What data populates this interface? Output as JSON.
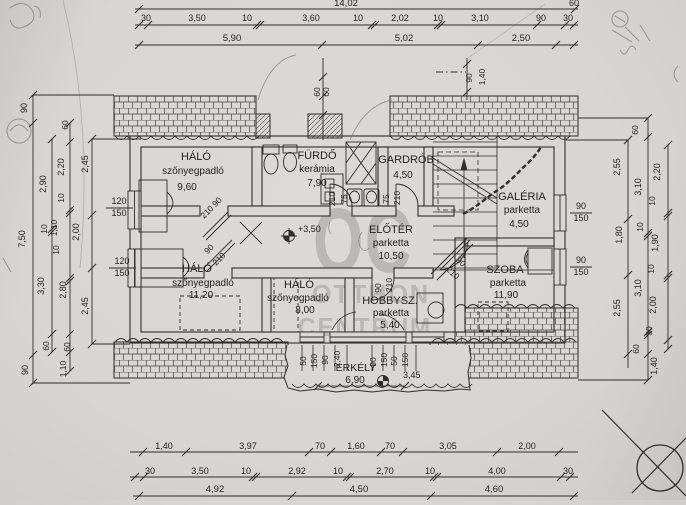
{
  "watermark": {
    "logo": "OC",
    "line1": "OTTHON",
    "line2": "CENTRUM"
  },
  "rooms": [
    {
      "name": "HÁLÓ",
      "finish": "szőnyegpadló",
      "area": "9,60"
    },
    {
      "name": "FÜRDŐ",
      "finish": "kerámia",
      "area": "7,90"
    },
    {
      "name": "GARDRÓB",
      "finish": "",
      "area": "4,50"
    },
    {
      "name": "GALÉRIA",
      "finish": "parketta",
      "area": "4,50"
    },
    {
      "name": "ELŐTÉR",
      "finish": "parketta",
      "area": "10,50"
    },
    {
      "name": "HÁLÓ",
      "finish": "szőnyegpadló",
      "area": "11,20"
    },
    {
      "name": "HÁLÓ",
      "finish": "szőnyegpadló",
      "area": "8,00"
    },
    {
      "name": "HOBBYSZ.",
      "finish": "parketta",
      "area": "5,40"
    },
    {
      "name": "SZOBA",
      "finish": "parketta",
      "area": "11,90"
    },
    {
      "name": "ERKÉLY",
      "finish": "",
      "area": "6,90"
    }
  ],
  "dims": {
    "top": {
      "total": "14,02",
      "row1": [
        "30",
        "3,50",
        "10",
        "3,60",
        "10",
        "2,02",
        "10",
        "3,10",
        "90",
        "30"
      ],
      "row2": [
        "5,90",
        "5,02",
        "2,50"
      ],
      "corner": "60"
    },
    "bottom": {
      "row1": [
        "1,40",
        "3,97",
        "70",
        "1,60",
        "70",
        "3,05",
        "2,00"
      ],
      "row2": [
        "30",
        "3,50",
        "10",
        "2,92",
        "10",
        "2,70",
        "10",
        "4,00",
        "30"
      ],
      "row3": [
        "4,92",
        "4,50",
        "4,60"
      ]
    },
    "left": [
      "90",
      "7,50",
      "90",
      "2,90",
      "10",
      "3,30",
      "60",
      "60",
      "2,20",
      "10",
      "1,10",
      "2,00",
      "10",
      "2,80",
      "60",
      "1,10",
      "2,45",
      "2,45"
    ],
    "right": [
      "60",
      "2,55",
      "3,10",
      "2,20",
      "10",
      "1,80",
      "10",
      "1,90",
      "10",
      "3,10",
      "2,55",
      "2,00",
      "30",
      "60",
      "1,40"
    ],
    "erkely": [
      "50",
      "150",
      "90",
      "2,40",
      "90",
      "150",
      "50",
      "150"
    ],
    "ridge": [
      "90",
      "1,40"
    ],
    "top_center": [
      "60",
      "60"
    ]
  },
  "openings": {
    "window_left": [
      "120",
      "150"
    ],
    "window_right": [
      "90",
      "150"
    ],
    "door_standard": [
      "90",
      "210"
    ],
    "door_small": [
      "75",
      "210"
    ]
  },
  "levels": {
    "upper": "+3,50",
    "balcony": "3,45"
  }
}
